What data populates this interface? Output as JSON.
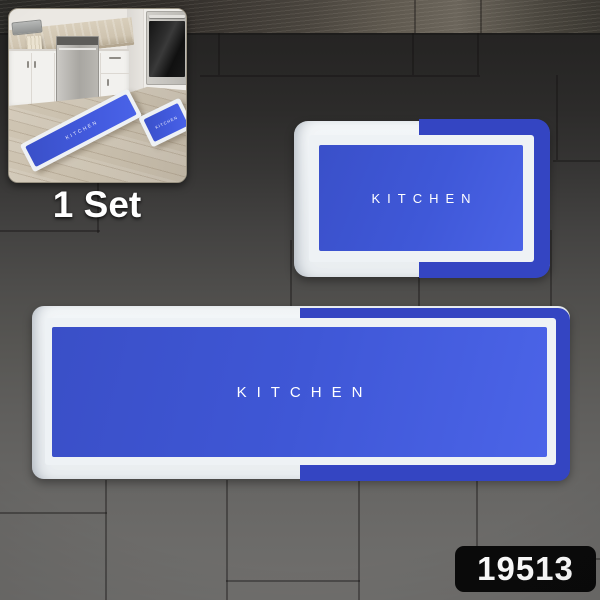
{
  "product": {
    "code": "19513",
    "set_label": "1 Set"
  },
  "mats": {
    "small": {
      "label": "KITCHEN"
    },
    "large": {
      "label": "KITCHEN"
    }
  },
  "inset": {
    "runner_label": "KITCHEN",
    "small_label": "KITCHEN"
  },
  "colors": {
    "mat_blue_center": "#3f58d8",
    "mat_blue_band": "#3445c2",
    "mat_white": "#eef1f4",
    "badge_bg": "#0a0a0a",
    "badge_text": "#ffffff",
    "floor_wood": "#c8beac",
    "tile_dark": "#262524",
    "tile_light": "#6f6e6c"
  }
}
